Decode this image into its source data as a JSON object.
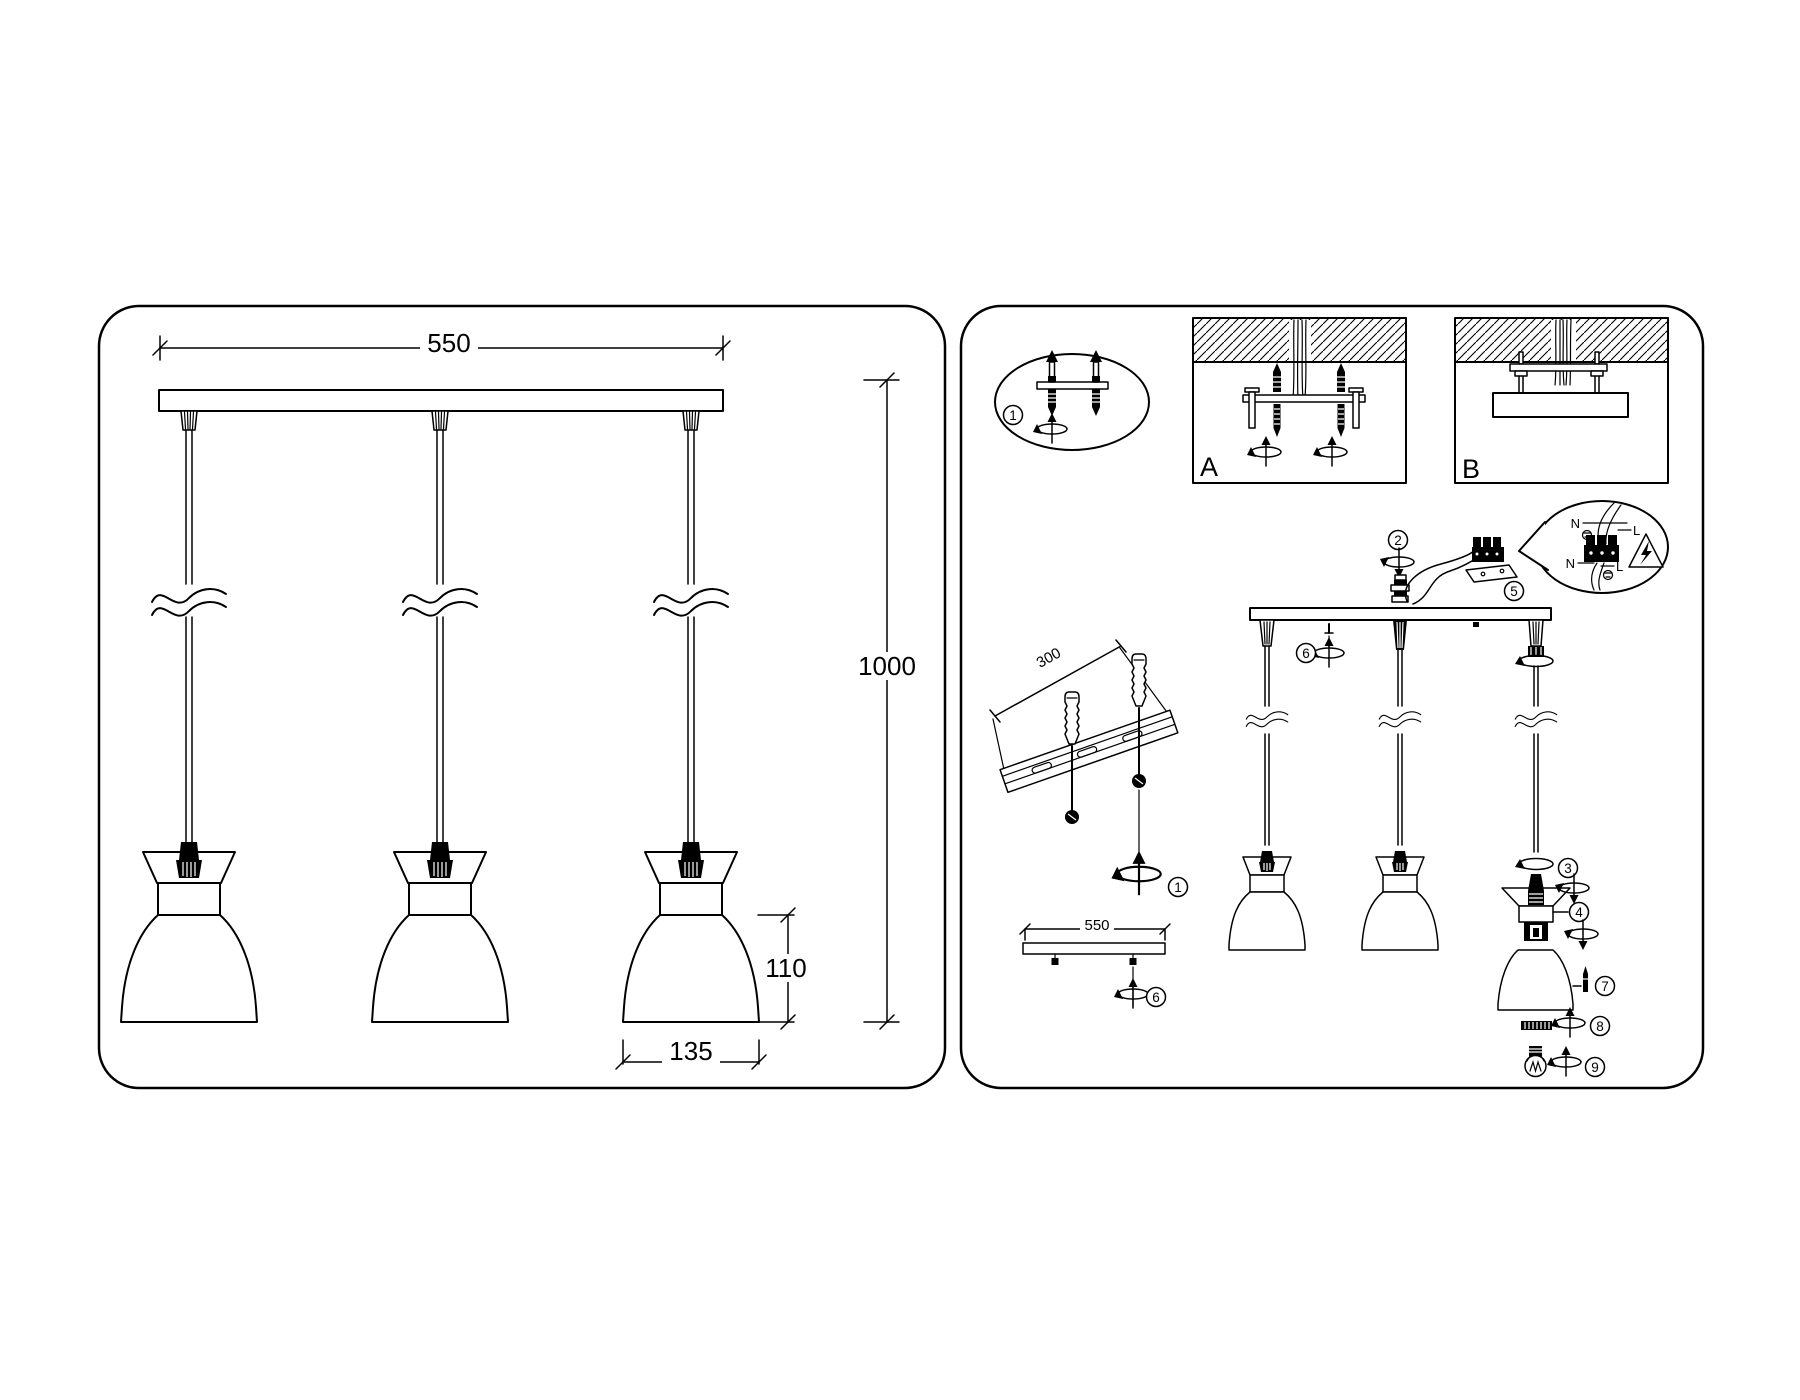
{
  "figure": {
    "left": {
      "dim_width": "550",
      "dim_height": "1000",
      "dim_shade_height": "110",
      "dim_shade_width": "135"
    },
    "right": {
      "label_a": "A",
      "label_b": "B",
      "dim_bracket": "300",
      "dim_canopy": "550",
      "wiring": {
        "n_top": "N",
        "l_top": "L",
        "n_bottom": "N",
        "l_bottom": "L"
      },
      "callouts": {
        "c1": "1",
        "c2": "2",
        "c3": "3",
        "c4": "4",
        "c5": "5",
        "c6": "6",
        "c7": "7",
        "c8": "8",
        "c9": "9"
      }
    }
  }
}
